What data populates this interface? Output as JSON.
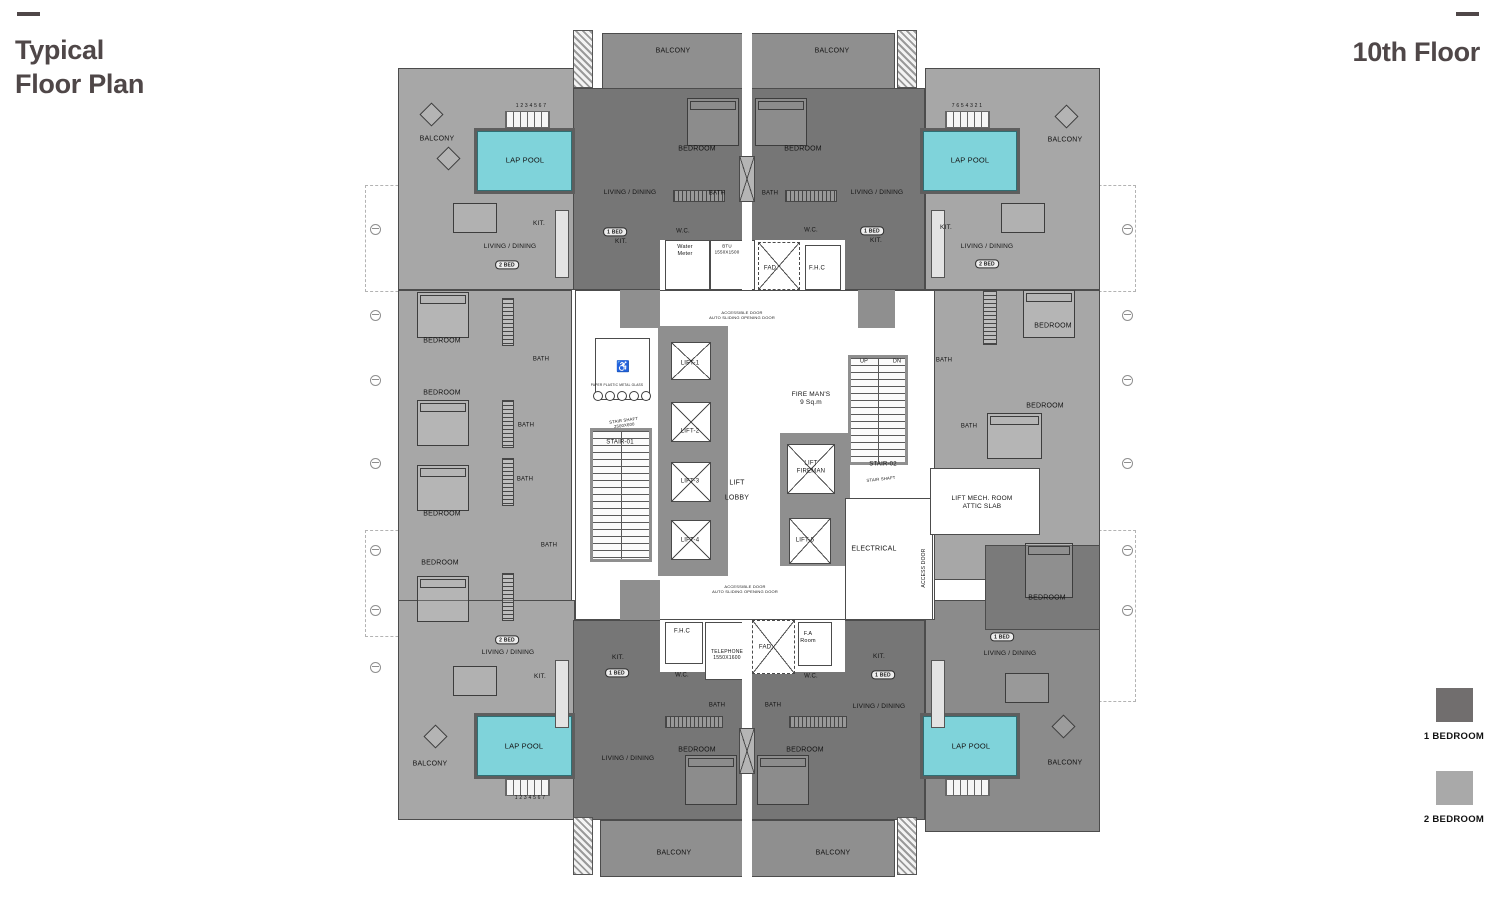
{
  "header": {
    "title": "Typical\nFloor Plan",
    "floor_label": "10th Floor",
    "accent_color": "#4f4748"
  },
  "legend": {
    "items": [
      {
        "label": "1 BEDROOM",
        "color": "#716e6e"
      },
      {
        "label": "2 BEDROOM",
        "color": "#a9a9a9"
      }
    ]
  },
  "plan": {
    "colors": {
      "pool": "#7fd3da",
      "one_bed": "#767676",
      "two_bed": "#a7a7a7",
      "balcony": "#8f8f8f",
      "corner_dark": "#8b8b8b",
      "wall": "#8f8f8f",
      "wing_dark": "#7a7a7a"
    },
    "labels": [
      {
        "text": "BALCONY",
        "x": 308,
        "y": 24,
        "size": 7
      },
      {
        "text": "BALCONY",
        "x": 467,
        "y": 24,
        "size": 7
      },
      {
        "text": "BALCONY",
        "x": 72,
        "y": 112,
        "size": 7
      },
      {
        "text": "BALCONY",
        "x": 700,
        "y": 113,
        "size": 7
      },
      {
        "text": "LAP POOL",
        "x": 160,
        "y": 132,
        "size": 7.5
      },
      {
        "text": "LAP POOL",
        "x": 605,
        "y": 132,
        "size": 7.5
      },
      {
        "text": "1 2 3 4 5 6 7",
        "x": 166,
        "y": 78,
        "size": 5
      },
      {
        "text": "7 6 5 4 3 2 1",
        "x": 602,
        "y": 78,
        "size": 5
      },
      {
        "text": "BEDROOM",
        "x": 332,
        "y": 122,
        "size": 7
      },
      {
        "text": "BEDROOM",
        "x": 438,
        "y": 122,
        "size": 7
      },
      {
        "text": "LIVING / DINING",
        "x": 265,
        "y": 165
      },
      {
        "text": "LIVING / DINING",
        "x": 512,
        "y": 165
      },
      {
        "text": "LIVING / DINING",
        "x": 145,
        "y": 219
      },
      {
        "text": "LIVING / DINING",
        "x": 622,
        "y": 219
      },
      {
        "text": "KIT.",
        "x": 174,
        "y": 196
      },
      {
        "text": "KIT.",
        "x": 581,
        "y": 200
      },
      {
        "text": "2 BED",
        "x": 142,
        "y": 237,
        "pill": true
      },
      {
        "text": "2 BED",
        "x": 622,
        "y": 236,
        "pill": true
      },
      {
        "text": "1 BED",
        "x": 250,
        "y": 204,
        "pill": true
      },
      {
        "text": "KIT.",
        "x": 256,
        "y": 214
      },
      {
        "text": "1 BED",
        "x": 507,
        "y": 203,
        "pill": true
      },
      {
        "text": "KIT.",
        "x": 511,
        "y": 213
      },
      {
        "text": "BATH",
        "x": 352,
        "y": 166,
        "size": 6
      },
      {
        "text": "BATH",
        "x": 405,
        "y": 166,
        "size": 6
      },
      {
        "text": "W.C.",
        "x": 318,
        "y": 204,
        "size": 6
      },
      {
        "text": "W.C.",
        "x": 446,
        "y": 203,
        "size": 6
      },
      {
        "text": "Water\nMeter",
        "x": 320,
        "y": 223,
        "size": 5.5
      },
      {
        "text": "BTU\n1550X1500",
        "x": 362,
        "y": 221,
        "size": 4.5
      },
      {
        "text": "FAD.",
        "x": 406,
        "y": 241,
        "size": 6
      },
      {
        "text": "F.H.C",
        "x": 452,
        "y": 241,
        "size": 6
      },
      {
        "text": "ACCESSIBLE DOOR\nAUTO SLIDING OPENING DOOR",
        "x": 377,
        "y": 287,
        "size": 4
      },
      {
        "text": "ACCESSIBLE DOOR\nAUTO SLIDING OPENING DOOR",
        "x": 380,
        "y": 561,
        "size": 4
      },
      {
        "text": "LIFT-1",
        "x": 325,
        "y": 336,
        "size": 6
      },
      {
        "text": "LIFT-2",
        "x": 325,
        "y": 404,
        "size": 6
      },
      {
        "text": "LIFT-3",
        "x": 325,
        "y": 454,
        "size": 6
      },
      {
        "text": "LIFT-4",
        "x": 325,
        "y": 513,
        "size": 6
      },
      {
        "text": "LIFT-5",
        "x": 440,
        "y": 513,
        "size": 6
      },
      {
        "text": "LIFT\nLOBBY",
        "x": 372,
        "y": 463,
        "size": 7,
        "lh": 2.1
      },
      {
        "text": "LIFT\nFIREMAN",
        "x": 446,
        "y": 440,
        "size": 6
      },
      {
        "text": "FIRE MAN'S\n9 Sq.m",
        "x": 446,
        "y": 371,
        "size": 6.5
      },
      {
        "text": "UP",
        "x": 499,
        "y": 334,
        "size": 5.5
      },
      {
        "text": "DN",
        "x": 532,
        "y": 334,
        "size": 5.5
      },
      {
        "text": "STAIR-01",
        "x": 255,
        "y": 415,
        "size": 6
      },
      {
        "text": "STAIR SHAFT\n2500X600",
        "x": 259,
        "y": 395,
        "size": 4.2,
        "rot": -8
      },
      {
        "text": "STAIR-02",
        "x": 518,
        "y": 437,
        "size": 6
      },
      {
        "text": "STAIR SHAFT",
        "x": 516,
        "y": 451,
        "size": 4.2,
        "rot": -6
      },
      {
        "text": "ELECTRICAL",
        "x": 509,
        "y": 522,
        "size": 7
      },
      {
        "text": "LIFT MECH. ROOM\nATTIC SLAB",
        "x": 617,
        "y": 475,
        "size": 6.5
      },
      {
        "text": "ACCESS DOOR",
        "x": 559,
        "y": 540,
        "size": 5,
        "rot": -90
      },
      {
        "text": "PAPER PLASTIC METAL GLASS",
        "x": 252,
        "y": 357,
        "size": 3.2
      },
      {
        "text": "♿",
        "x": 258,
        "y": 340,
        "size": 11
      },
      {
        "text": "BEDROOM",
        "x": 77,
        "y": 314,
        "size": 7
      },
      {
        "text": "BEDROOM",
        "x": 77,
        "y": 366,
        "size": 7
      },
      {
        "text": "BEDROOM",
        "x": 77,
        "y": 487,
        "size": 7
      },
      {
        "text": "BEDROOM",
        "x": 75,
        "y": 536,
        "size": 7
      },
      {
        "text": "BATH",
        "x": 176,
        "y": 332,
        "size": 6
      },
      {
        "text": "BATH",
        "x": 161,
        "y": 398,
        "size": 6
      },
      {
        "text": "BATH",
        "x": 160,
        "y": 452,
        "size": 6
      },
      {
        "text": "BATH",
        "x": 184,
        "y": 518,
        "size": 6
      },
      {
        "text": "BEDROOM",
        "x": 688,
        "y": 299,
        "size": 7
      },
      {
        "text": "BEDROOM",
        "x": 680,
        "y": 379,
        "size": 7
      },
      {
        "text": "BEDROOM",
        "x": 682,
        "y": 571,
        "size": 7
      },
      {
        "text": "BATH",
        "x": 579,
        "y": 333,
        "size": 6
      },
      {
        "text": "BATH",
        "x": 604,
        "y": 399,
        "size": 6
      },
      {
        "text": "F.H.C",
        "x": 317,
        "y": 604,
        "size": 6
      },
      {
        "text": "TELEPHONE\n1550X1600",
        "x": 362,
        "y": 627,
        "size": 5
      },
      {
        "text": "FAD.",
        "x": 401,
        "y": 620,
        "size": 6
      },
      {
        "text": "F.A\nRoom",
        "x": 443,
        "y": 610,
        "size": 5.5
      },
      {
        "text": "W.C.",
        "x": 317,
        "y": 648,
        "size": 6
      },
      {
        "text": "W.C.",
        "x": 446,
        "y": 649,
        "size": 6
      },
      {
        "text": "BATH",
        "x": 352,
        "y": 678,
        "size": 6
      },
      {
        "text": "BATH",
        "x": 408,
        "y": 678,
        "size": 6
      },
      {
        "text": "KIT.",
        "x": 253,
        "y": 630
      },
      {
        "text": "1 BED",
        "x": 252,
        "y": 645,
        "pill": true
      },
      {
        "text": "KIT.",
        "x": 514,
        "y": 629
      },
      {
        "text": "1 BED",
        "x": 518,
        "y": 647,
        "pill": true
      },
      {
        "text": "LIVING / DINING",
        "x": 263,
        "y": 731
      },
      {
        "text": "LIVING / DINING",
        "x": 514,
        "y": 679
      },
      {
        "text": "BEDROOM",
        "x": 332,
        "y": 723,
        "size": 7
      },
      {
        "text": "BEDROOM",
        "x": 440,
        "y": 723,
        "size": 7
      },
      {
        "text": "BALCONY",
        "x": 309,
        "y": 826,
        "size": 7
      },
      {
        "text": "BALCONY",
        "x": 468,
        "y": 826,
        "size": 7
      },
      {
        "text": "2 BED",
        "x": 142,
        "y": 612,
        "pill": true
      },
      {
        "text": "LIVING / DINING",
        "x": 143,
        "y": 625
      },
      {
        "text": "KIT.",
        "x": 175,
        "y": 649
      },
      {
        "text": "LAP POOL",
        "x": 159,
        "y": 718,
        "size": 7.5
      },
      {
        "text": "BALCONY",
        "x": 65,
        "y": 737,
        "size": 7
      },
      {
        "text": "1 2 3 4 5 6 7",
        "x": 165,
        "y": 770,
        "size": 5
      },
      {
        "text": "1 BED",
        "x": 637,
        "y": 609,
        "pill": true
      },
      {
        "text": "LIVING / DINING",
        "x": 645,
        "y": 626
      },
      {
        "text": "LAP POOL",
        "x": 606,
        "y": 718,
        "size": 7.5
      },
      {
        "text": "BALCONY",
        "x": 700,
        "y": 736,
        "size": 7
      }
    ]
  }
}
